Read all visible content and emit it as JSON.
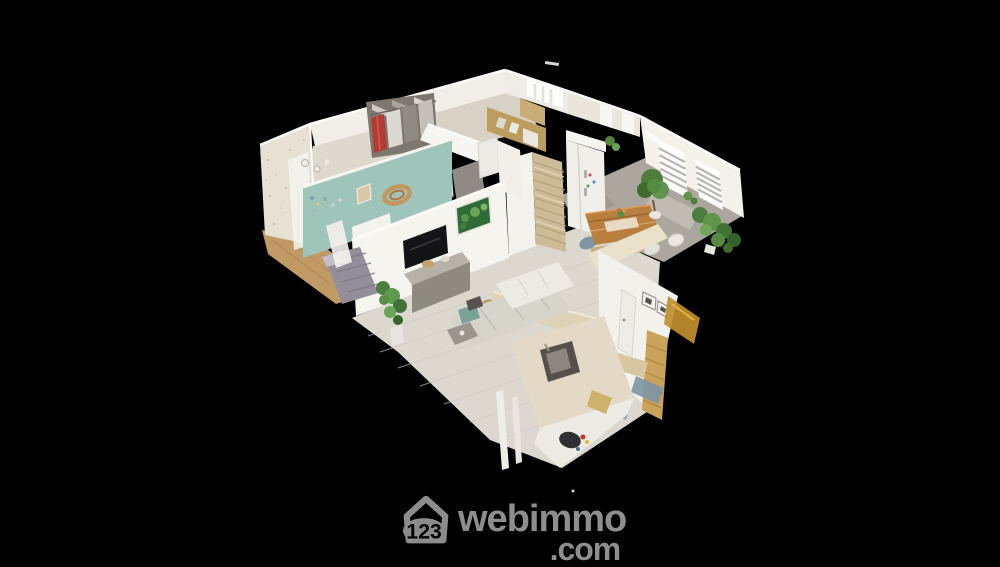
{
  "viewer": {
    "alt": "3D dollhouse cutaway view of a furnished apartment seen from above on a black background",
    "background_color": "#000000"
  },
  "logo": {
    "brand_number": "123",
    "brand_name": "webimmo",
    "brand_tld": ".com",
    "color": "#8e8e8e"
  },
  "palette": {
    "background": "#000000",
    "logo_gray": "#8e8e8e",
    "teal_accent_wall": "#9fc4b9",
    "stone_column": "#cdbb97",
    "khaki_wall": "#bd9d5e",
    "living_floor": "#dcd8d0",
    "dining_tile": "#aba69e",
    "bedroom_wood_floor": "#c29a66",
    "dining_table_wood": "#b97f3f",
    "plant_green": "#5f9449",
    "closet_red_clothes": "#b5423a",
    "white_walls": "#f3f1ea"
  }
}
